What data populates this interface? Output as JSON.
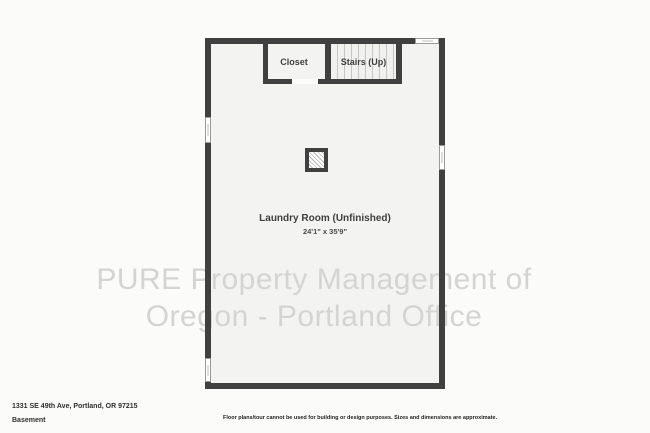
{
  "plan": {
    "rooms": {
      "closet_label": "Closet",
      "stairs_label": "Stairs (Up)",
      "laundry_label": "Laundry Room (Unfinished)",
      "laundry_dimensions": "24'1\" x 35'9\""
    },
    "watermark": {
      "line1": "PURE Property Management of",
      "line2": "Oregon - Portland Office"
    }
  },
  "footer": {
    "address": "1331 SE 49th Ave, Portland, OR 97215",
    "floor_name": "Basement",
    "disclaimer": "Floor plans/tour cannot be used for building or design purposes. Sizes and dimensions are approximate."
  },
  "colors": {
    "wall": "#404040",
    "floor": "#f3f3f1",
    "background": "#fbfbfa",
    "watermark": "#d4d4d3"
  }
}
